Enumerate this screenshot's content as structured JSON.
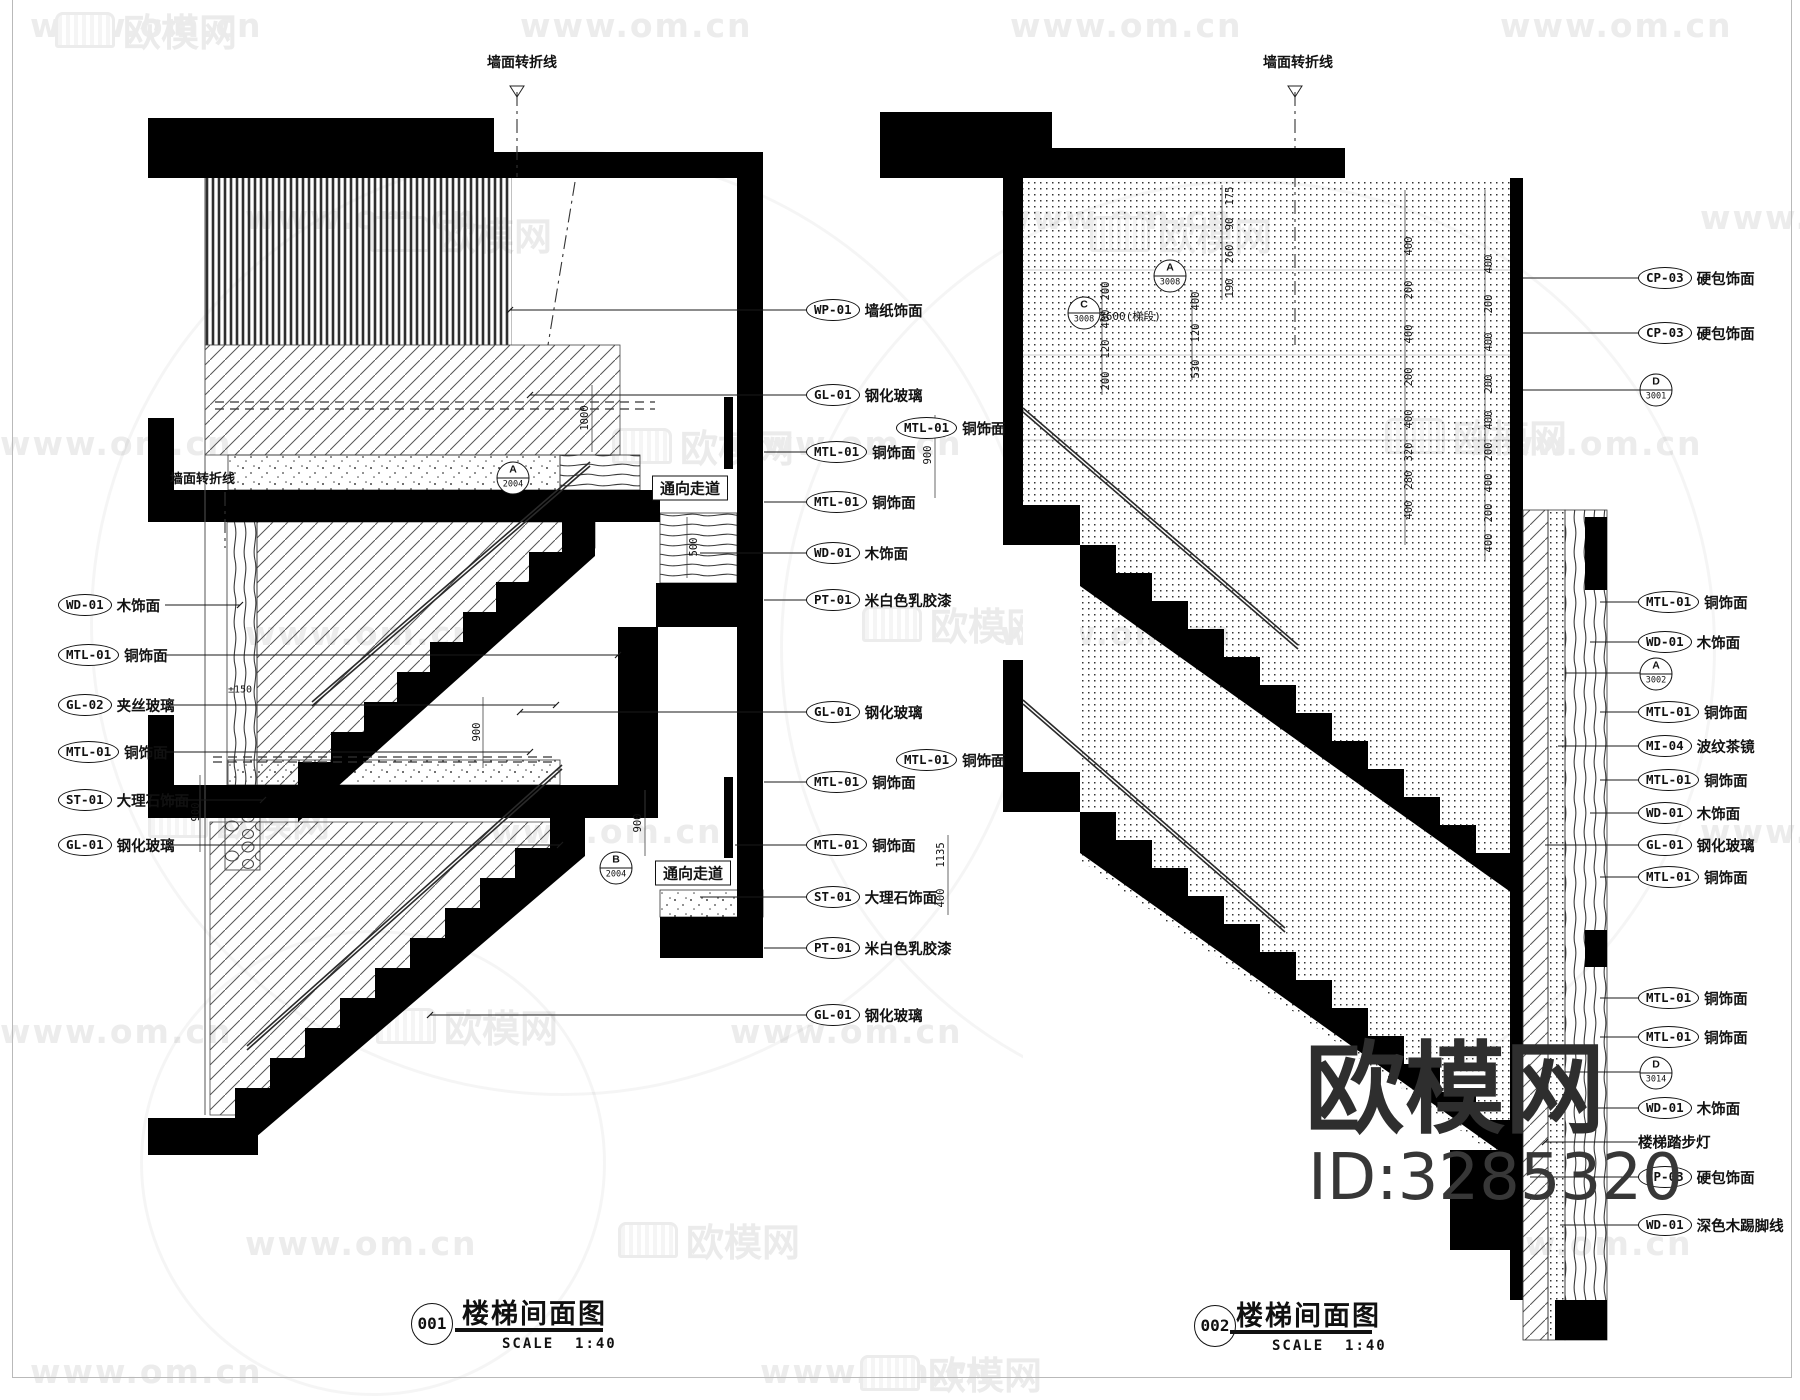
{
  "watermark": {
    "www": "www.om.cn",
    "brand": "欧模网",
    "id": "ID:3285320"
  },
  "drawing1": {
    "number": "001",
    "title": "楼梯间面图",
    "scale_label": "SCALE",
    "scale_value": "1:40",
    "top_fold_label": "墙面转折线",
    "left_fold_label": "墙面转折线",
    "corridor_label": "通向走道",
    "markers": [
      {
        "letter": "A",
        "number": "2004"
      },
      {
        "letter": "B",
        "number": "2004"
      }
    ],
    "callouts_left": [
      {
        "code": "WD-01",
        "label": "木饰面"
      },
      {
        "code": "MTL-01",
        "label": "铜饰面"
      },
      {
        "code": "GL-02",
        "label": "夹丝玻璃"
      },
      {
        "code": "MTL-01",
        "label": "铜饰面"
      },
      {
        "code": "ST-01",
        "label": "大理石饰面"
      },
      {
        "code": "GL-01",
        "label": "钢化玻璃"
      }
    ],
    "callouts_right": [
      {
        "code": "WP-01",
        "label": "墙纸饰面"
      },
      {
        "code": "GL-01",
        "label": "钢化玻璃"
      },
      {
        "code": "MTL-01",
        "label": "铜饰面"
      },
      {
        "code": "MTL-01",
        "label": "铜饰面"
      },
      {
        "code": "WD-01",
        "label": "木饰面"
      },
      {
        "code": "PT-01",
        "label": "米白色乳胶漆"
      },
      {
        "code": "GL-01",
        "label": "钢化玻璃"
      },
      {
        "code": "MTL-01",
        "label": "铜饰面"
      },
      {
        "code": "MTL-01",
        "label": "铜饰面"
      },
      {
        "code": "ST-01",
        "label": "大理石饰面"
      },
      {
        "code": "PT-01",
        "label": "米白色乳胶漆"
      },
      {
        "code": "GL-01",
        "label": "钢化玻璃"
      }
    ],
    "dims": {
      "h1000": "1000",
      "h500": "500",
      "h900a": "900",
      "h900b": "900",
      "h900c": "900",
      "lvl": "±150"
    }
  },
  "drawing2": {
    "number": "002",
    "title": "楼梯间面图",
    "scale_label": "SCALE",
    "scale_value": "1:40",
    "top_fold_label": "墙面转折线",
    "step_light": "楼梯踏步灯",
    "markers": [
      {
        "letter": "C",
        "number": "3008"
      },
      {
        "letter": "A",
        "number": "3008"
      },
      {
        "letter": "D",
        "number": "3001"
      },
      {
        "letter": "A",
        "number": "3002"
      },
      {
        "letter": "D",
        "number": "3014"
      }
    ],
    "callouts_left": [
      {
        "code": "MTL-01",
        "label": "铜饰面"
      },
      {
        "code": "MTL-01",
        "label": "铜饰面"
      }
    ],
    "callouts_right": [
      {
        "code": "CP-03",
        "label": "硬包饰面"
      },
      {
        "code": "CP-03",
        "label": "硬包饰面"
      },
      {
        "code": "MTL-01",
        "label": "铜饰面"
      },
      {
        "code": "WD-01",
        "label": "木饰面"
      },
      {
        "code": "MTL-01",
        "label": "铜饰面"
      },
      {
        "code": "MI-04",
        "label": "波纹茶镜"
      },
      {
        "code": "MTL-01",
        "label": "铜饰面"
      },
      {
        "code": "WD-01",
        "label": "木饰面"
      },
      {
        "code": "GL-01",
        "label": "钢化玻璃"
      },
      {
        "code": "MTL-01",
        "label": "铜饰面"
      },
      {
        "code": "MTL-01",
        "label": "铜饰面"
      },
      {
        "code": "MTL-01",
        "label": "铜饰面"
      },
      {
        "code": "WD-01",
        "label": "木饰面"
      },
      {
        "code": "CP-03",
        "label": "硬包饰面"
      },
      {
        "code": "WD-01",
        "label": "深色木踢脚线"
      }
    ],
    "dims": {
      "col1": [
        "400",
        "200",
        "400",
        "200",
        "400",
        "320",
        "280",
        "400"
      ],
      "col2": [
        "400",
        "200",
        "400",
        "200",
        "400",
        "200",
        "400",
        "200",
        "400"
      ],
      "col3": [
        "175",
        "90",
        "260",
        "190"
      ],
      "col4": [
        "200",
        "400",
        "120",
        "200"
      ],
      "col5": [
        "400",
        "120",
        "530"
      ],
      "run": "3600(梯段)",
      "h900": "900",
      "h1135": "1135",
      "h400": "400"
    }
  }
}
